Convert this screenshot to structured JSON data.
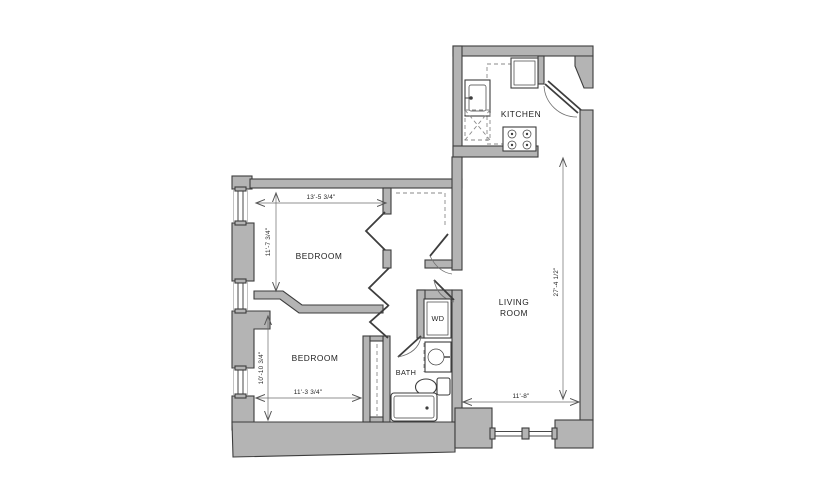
{
  "plan": {
    "rooms": {
      "kitchen": "KITCHEN",
      "living_line1": "LIVING",
      "living_line2": "ROOM",
      "bedroom_top": "BEDROOM",
      "bedroom_bottom": "BEDROOM",
      "bath": "BATH",
      "wd": "WD"
    },
    "dimensions": {
      "bedroom_top_width": "13'-5 3/4\"",
      "bedroom_top_depth": "11'-7 3/4\"",
      "bedroom_bottom_depth": "10'-10 3/4\"",
      "bedroom_bottom_width": "11'-3 3/4\"",
      "living_height": "27'-4 1/2\"",
      "living_width": "11'-8\""
    },
    "fixtures": [
      "refrigerator",
      "kitchen-sink",
      "dishwasher",
      "range-stove",
      "washer-dryer",
      "bath-sink",
      "toilet",
      "bathtub"
    ],
    "colors": {
      "wall_fill": "#b4b4b4",
      "wall_stroke": "#3d3d3d",
      "background": "#ffffff",
      "dim_line": "#6b6b6b",
      "text": "#1f1f1f"
    }
  }
}
